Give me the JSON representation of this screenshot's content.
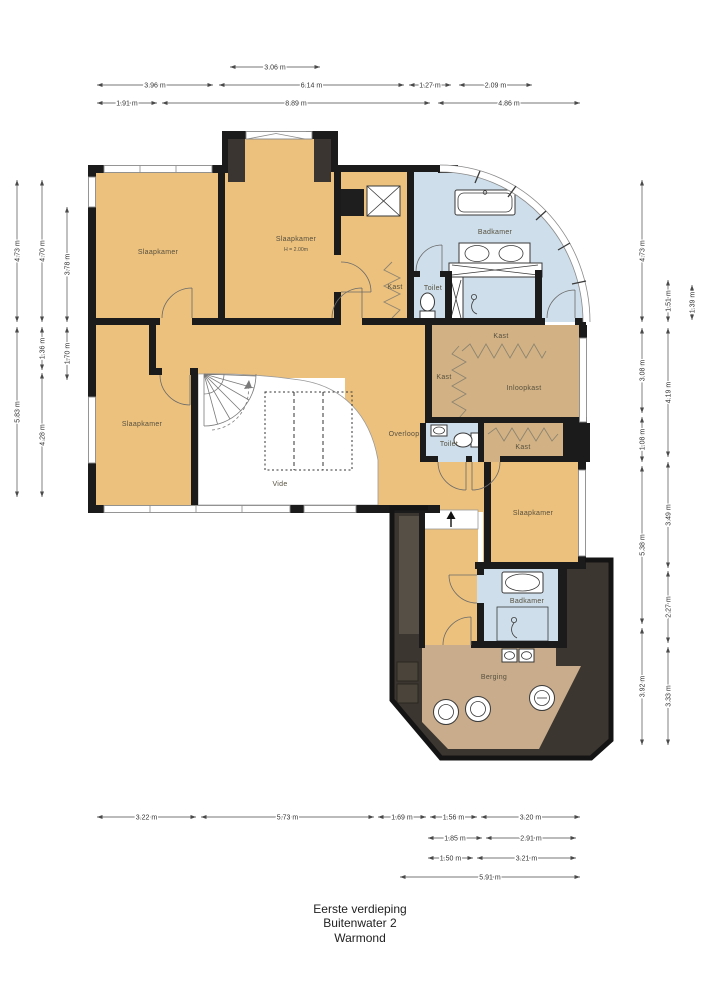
{
  "footer": {
    "line1": "Eerste verdieping",
    "line2": "Buitenwater 2",
    "line3": "Warmond"
  },
  "colors": {
    "wall": "#1b1b1b",
    "room": "#ecc17d",
    "closet": "#d2b284",
    "storage": "#c8ac8b",
    "wet": "#cedeea",
    "framedark": "#3c3630",
    "frameinner": "#564f45",
    "window": "#8a8a8a",
    "dim": "#4a4a4a"
  },
  "rooms": [
    {
      "id": "slaapkamer-1",
      "label": "Slaapkamer",
      "x": 158,
      "y": 254
    },
    {
      "id": "slaapkamer-2",
      "label": "Slaapkamer",
      "x": 296,
      "y": 241,
      "sub": "H = 2.00m",
      "sub_y": 251
    },
    {
      "id": "slaapkamer-3",
      "label": "Slaapkamer",
      "x": 142,
      "y": 426
    },
    {
      "id": "slaapkamer-4",
      "label": "Slaapkamer",
      "x": 533,
      "y": 515
    },
    {
      "id": "badkamer-1",
      "label": "Badkamer",
      "x": 495,
      "y": 234
    },
    {
      "id": "badkamer-2",
      "label": "Badkamer",
      "x": 527,
      "y": 603
    },
    {
      "id": "toilet-1",
      "label": "Toilet",
      "x": 433,
      "y": 290
    },
    {
      "id": "toilet-2",
      "label": "Toilet",
      "x": 449,
      "y": 446
    },
    {
      "id": "kast-1",
      "label": "Kast",
      "x": 395,
      "y": 289
    },
    {
      "id": "kast-2",
      "label": "Kast",
      "x": 501,
      "y": 338
    },
    {
      "id": "kast-3",
      "label": "Kast",
      "x": 444,
      "y": 379
    },
    {
      "id": "kast-4",
      "label": "Kast",
      "x": 523,
      "y": 449
    },
    {
      "id": "inloopkast",
      "label": "Inloopkast",
      "x": 524,
      "y": 390
    },
    {
      "id": "overloop",
      "label": "Overloop",
      "x": 404,
      "y": 436
    },
    {
      "id": "vide",
      "label": "Vide",
      "x": 280,
      "y": 486
    },
    {
      "id": "berging",
      "label": "Berging",
      "x": 494,
      "y": 679
    }
  ],
  "dimensions": {
    "top": [
      {
        "label": "3.06 m",
        "x1": 230,
        "x2": 320,
        "y": 67
      },
      {
        "label": "3.96 m",
        "x1": 97,
        "x2": 213,
        "y": 85
      },
      {
        "label": "6.14 m",
        "x1": 219,
        "x2": 404,
        "y": 85
      },
      {
        "label": "1.27 m",
        "x1": 409,
        "x2": 451,
        "y": 85
      },
      {
        "label": "2.09 m",
        "x1": 459,
        "x2": 532,
        "y": 85
      },
      {
        "label": "1.91 m",
        "x1": 97,
        "x2": 157,
        "y": 103
      },
      {
        "label": "8.89 m",
        "x1": 162,
        "x2": 430,
        "y": 103
      },
      {
        "label": "4.86 m",
        "x1": 438,
        "x2": 580,
        "y": 103
      }
    ],
    "bottom": [
      {
        "label": "3.22 m",
        "x1": 97,
        "x2": 196,
        "y": 817
      },
      {
        "label": "5.73 m",
        "x1": 201,
        "x2": 374,
        "y": 817
      },
      {
        "label": "1.69 m",
        "x1": 378,
        "x2": 426,
        "y": 817
      },
      {
        "label": "1.56 m",
        "x1": 430,
        "x2": 477,
        "y": 817
      },
      {
        "label": "3.20 m",
        "x1": 481,
        "x2": 580,
        "y": 817
      },
      {
        "label": "1.85 m",
        "x1": 428,
        "x2": 482,
        "y": 838
      },
      {
        "label": "2.91 m",
        "x1": 486,
        "x2": 576,
        "y": 838
      },
      {
        "label": "1.50 m",
        "x1": 428,
        "x2": 473,
        "y": 858
      },
      {
        "label": "3.21 m",
        "x1": 477,
        "x2": 576,
        "y": 858
      },
      {
        "label": "5.91 m",
        "x1": 400,
        "x2": 580,
        "y": 877
      }
    ],
    "left": [
      {
        "label": "4.73 m",
        "x": 17,
        "y1": 180,
        "y2": 322
      },
      {
        "label": "5.83 m",
        "x": 17,
        "y1": 327,
        "y2": 497
      },
      {
        "label": "4.70 m",
        "x": 42,
        "y1": 180,
        "y2": 322
      },
      {
        "label": "1.36 m",
        "x": 42,
        "y1": 327,
        "y2": 370
      },
      {
        "label": "4.28 m",
        "x": 42,
        "y1": 373,
        "y2": 497
      },
      {
        "label": "3.78 m",
        "x": 67,
        "y1": 207,
        "y2": 322
      },
      {
        "label": "1.70 m",
        "x": 67,
        "y1": 327,
        "y2": 380
      }
    ],
    "right": [
      {
        "label": "4.73 m",
        "x": 642,
        "y1": 180,
        "y2": 322
      },
      {
        "label": "3.08 m",
        "x": 642,
        "y1": 328,
        "y2": 413
      },
      {
        "label": "1.08 m",
        "x": 642,
        "y1": 417,
        "y2": 462
      },
      {
        "label": "5.38 m",
        "x": 642,
        "y1": 466,
        "y2": 624
      },
      {
        "label": "3.92 m",
        "x": 642,
        "y1": 628,
        "y2": 745
      },
      {
        "label": "1.51 m",
        "x": 668,
        "y1": 280,
        "y2": 322
      },
      {
        "label": "4.19 m",
        "x": 668,
        "y1": 328,
        "y2": 457
      },
      {
        "label": "3.49 m",
        "x": 668,
        "y1": 462,
        "y2": 568
      },
      {
        "label": "2.27 m",
        "x": 668,
        "y1": 571,
        "y2": 643
      },
      {
        "label": "3.33 m",
        "x": 668,
        "y1": 647,
        "y2": 745
      },
      {
        "label": "1.39 m",
        "x": 692,
        "y1": 285,
        "y2": 320
      }
    ]
  }
}
